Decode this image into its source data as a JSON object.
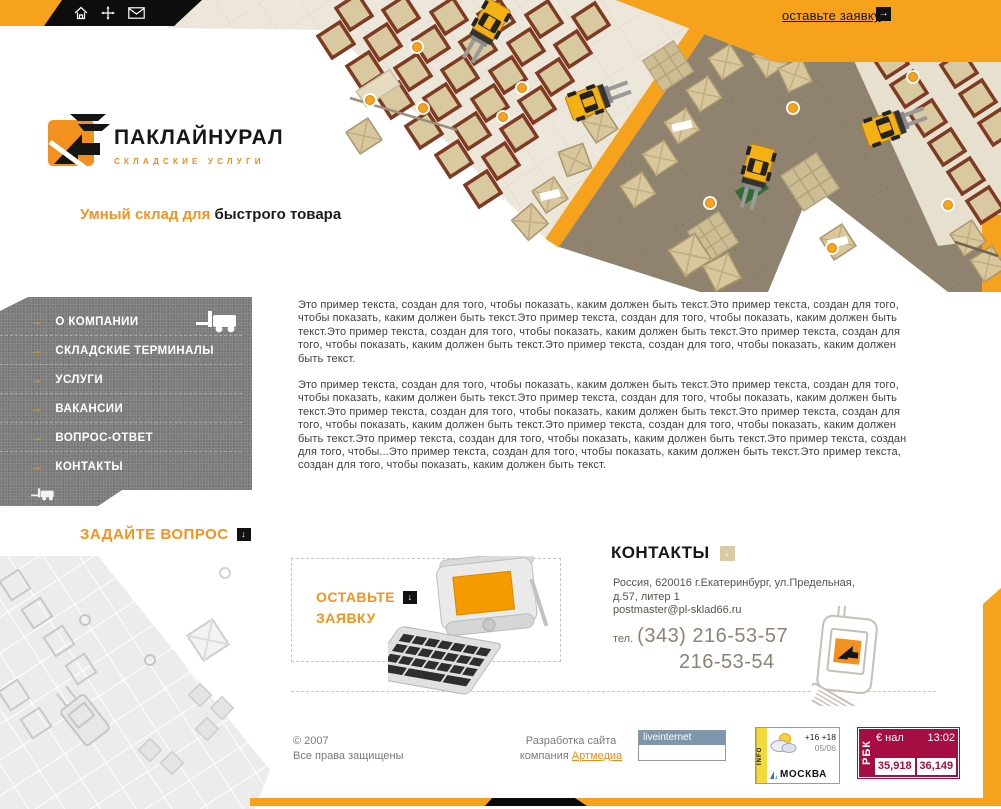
{
  "topbar": {
    "request_label": "оставьте заявку",
    "request_arrow": "→"
  },
  "logo": {
    "title": "ПАКЛАЙНУРАЛ",
    "subtitle": "СКЛАДСКИЕ УСЛУГИ"
  },
  "tagline": {
    "highlight": "Умный склад для",
    "rest": " быстрого товара"
  },
  "menu": {
    "arrow": "→",
    "items": [
      {
        "label": "О КОМПАНИИ"
      },
      {
        "label": "СКЛАДСКИЕ ТЕРМИНАЛЫ"
      },
      {
        "label": "УСЛУГИ"
      },
      {
        "label": "ВАКАНСИИ"
      },
      {
        "label": "ВОПРОС-ОТВЕТ"
      },
      {
        "label": "КОНТАКТЫ"
      }
    ]
  },
  "content": {
    "paragraph1": "Это пример текста, создан для того, чтобы показать, каким должен быть текст.Это пример текста, создан для того, чтобы показать, каким должен быть текст.Это пример текста, создан для того, чтобы показать, каким должен быть текст.Это пример текста, создан для того, чтобы показать, каким должен быть текст.Это пример текста, создан для того, чтобы показать, каким должен быть текст.Это пример текста, создан для того, чтобы показать, каким должен быть текст.",
    "paragraph2": "Это пример текста, создан для того, чтобы показать, каким должен быть текст.Это пример текста, создан для того, чтобы показать, каким должен быть текст.Это пример текста, создан для того, чтобы показать, каким должен быть текст.Это пример текста, создан для того, чтобы показать, каким должен быть текст.Это пример текста, создан для того, чтобы показать, каким должен быть текст.Это пример текста, создан для того, чтобы показать, каким должен быть текст.Это пример текста, создан для того, чтобы показать, каким должен быть текст.Это пример текста, создан для того, чтобы...Это пример текста, создан для того, чтобы показать, каким должен быть текст.Это пример текста, создан для того, чтобы показать, каким должен быть текст."
  },
  "ask_question": {
    "label": "ЗАДАЙТЕ ВОПРОС",
    "arrow": "↓"
  },
  "request_box": {
    "line1": "ОСТАВЬТЕ",
    "line2": "ЗАЯВКУ",
    "arrow": "↓"
  },
  "contacts": {
    "title": "КОНТАКТЫ",
    "arrow": "↓",
    "address_line1": "Россия, 620016 г.Екатеринбург, ул.Предельная,",
    "address_line2": "д.57, литер 1",
    "email": "postmaster@pl-sklad66.ru",
    "phone_prefix": "тел.",
    "phone_main": "(343) 216-53-57",
    "phone_alt": "216-53-54"
  },
  "footer": {
    "copyright": "© 2007",
    "rights": "Все права защищены",
    "dev_line1": "Разработка сайта",
    "dev_prefix": "компания ",
    "dev_link": "Артмедиа"
  },
  "badges": {
    "liveinternet": "liveinternet",
    "weather": {
      "strip": "INFO",
      "temps": "+16 +18",
      "date": "05/06",
      "city": "МОСКВА"
    },
    "rbc": {
      "brand": "РБК",
      "pair": "€ нал",
      "time": "13:02",
      "rate_buy": "35,918",
      "rate_sell": "36,149"
    }
  },
  "colors": {
    "accent": "#F6A21D",
    "rbc_bg": "#A60D42",
    "liveinternet_header": "#7E96AB"
  }
}
